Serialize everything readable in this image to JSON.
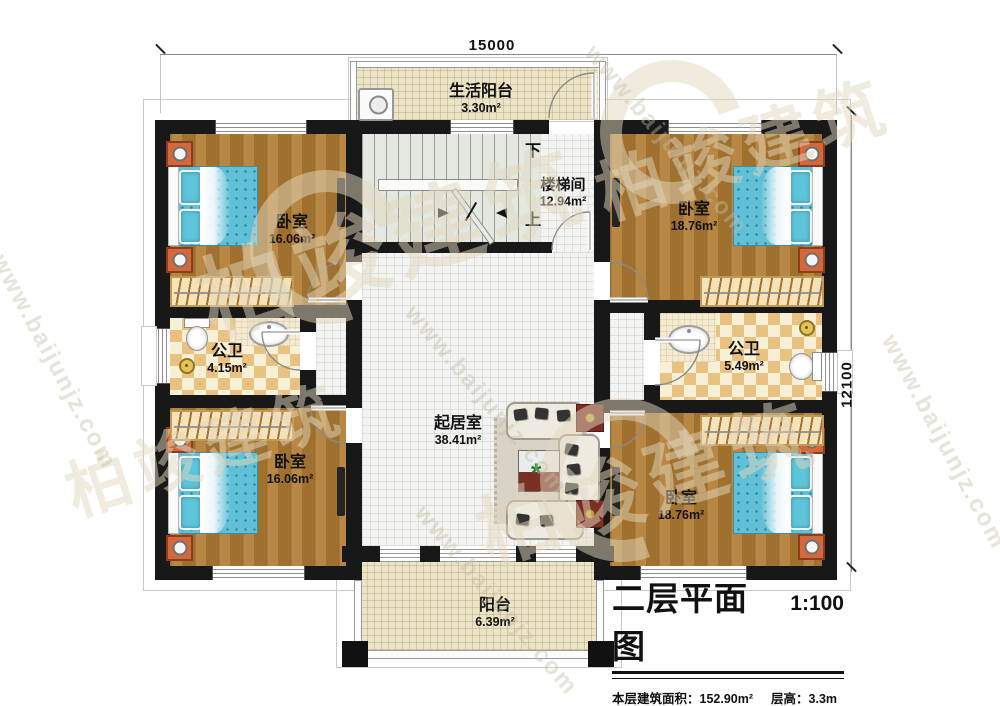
{
  "plan": {
    "title": "二层平面图",
    "scale": "1:100",
    "floor_area": "本层建筑面积：152.90m²",
    "floor_height": "层高：3.3m",
    "dim_top": "15000",
    "dim_right": "12100"
  },
  "rooms": {
    "life_balcony": {
      "name": "生活阳台",
      "area": "3.30m²"
    },
    "stairwell": {
      "name": "楼梯间",
      "area": "12.94m²",
      "down_label": "下",
      "up_label": "上"
    },
    "bedroom_top_left": {
      "name": "卧室",
      "area": "16.06m²"
    },
    "bedroom_top_right": {
      "name": "卧室",
      "area": "18.76m²"
    },
    "bathroom_left": {
      "name": "公卫",
      "area": "4.15m²"
    },
    "bathroom_right": {
      "name": "公卫",
      "area": "5.49m²"
    },
    "living_room": {
      "name": "起居室",
      "area": "38.41m²"
    },
    "bedroom_bottom_left": {
      "name": "卧室",
      "area": "16.06m²"
    },
    "bedroom_bottom_right": {
      "name": "卧室",
      "area": "18.76m²"
    },
    "balcony": {
      "name": "阳台",
      "area": "6.39m²"
    }
  },
  "watermark": {
    "site": "www.baijunjz.com",
    "brand": "柏竣建筑"
  },
  "colors": {
    "wall": "#181818",
    "wood": "#ac7832",
    "bed": "#5fc0d8",
    "bath_tile": "#e9c282",
    "hall_tile": "#f3f3f1",
    "balcony_tile": "#ece4c7"
  }
}
